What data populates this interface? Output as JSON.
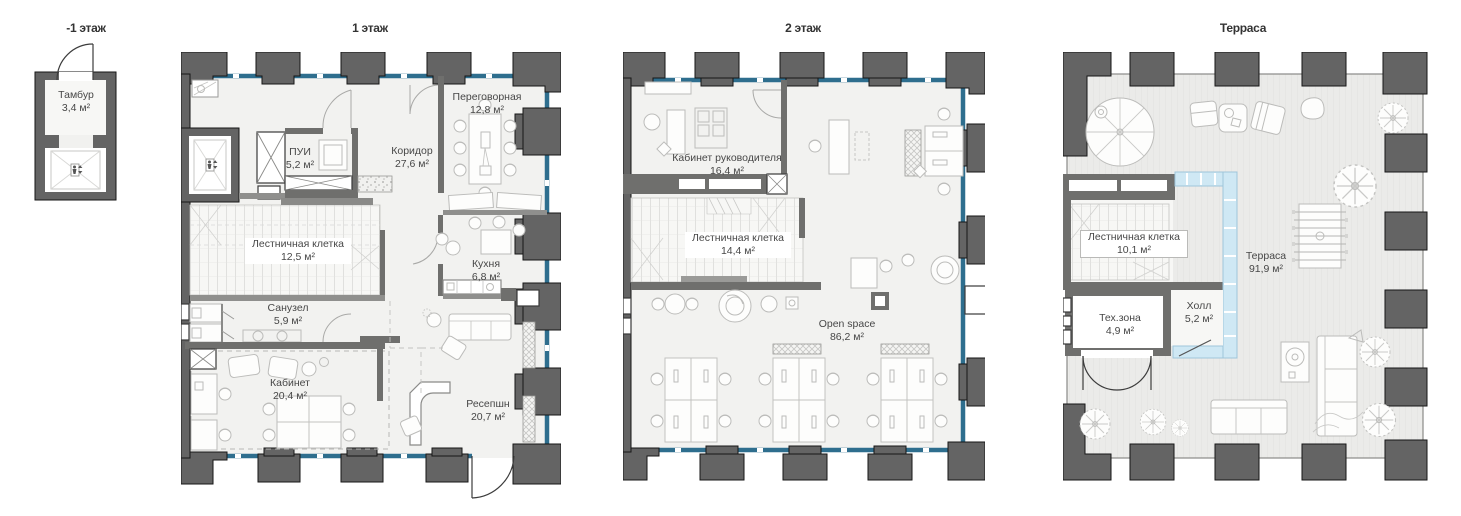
{
  "document_type": "floor-plans",
  "colors": {
    "wall": "#646464",
    "window": "#2e6e8e",
    "glass": "#cfe8f4",
    "floor": "#f2f2f0",
    "terrace_floor": "#ebebe9",
    "furniture_line": "#bcbcba",
    "text": "#474747"
  },
  "plans": [
    {
      "title": "-1 этаж",
      "rooms": [
        {
          "name": "Тамбур",
          "area": "3,4 м²"
        }
      ]
    },
    {
      "title": "1 этаж",
      "rooms": [
        {
          "name": "Переговорная",
          "area": "12,8 м²"
        },
        {
          "name": "Коридор",
          "area": "27,6 м²"
        },
        {
          "name": "ПУИ",
          "area": "5,2 м²"
        },
        {
          "name": "Лестничная клетка",
          "area": "12,5 м²"
        },
        {
          "name": "Кухня",
          "area": "6,8 м²"
        },
        {
          "name": "Санузел",
          "area": "5,9 м²"
        },
        {
          "name": "Кабинет",
          "area": "20,4 м²"
        },
        {
          "name": "Ресепшн",
          "area": "20,7 м²"
        }
      ]
    },
    {
      "title": "2 этаж",
      "rooms": [
        {
          "name": "Кабинет руководителя",
          "area": "16,4 м²"
        },
        {
          "name": "Лестничная клетка",
          "area": "14,4 м²"
        },
        {
          "name": "Open space",
          "area": "86,2 м²"
        }
      ]
    },
    {
      "title": "Терраса",
      "rooms": [
        {
          "name": "Лестничная клетка",
          "area": "10,1 м²"
        },
        {
          "name": "Терраса",
          "area": "91,9 м²"
        },
        {
          "name": "Тех.зона",
          "area": "4,9 м²"
        },
        {
          "name": "Холл",
          "area": "5,2 м²"
        }
      ]
    }
  ]
}
